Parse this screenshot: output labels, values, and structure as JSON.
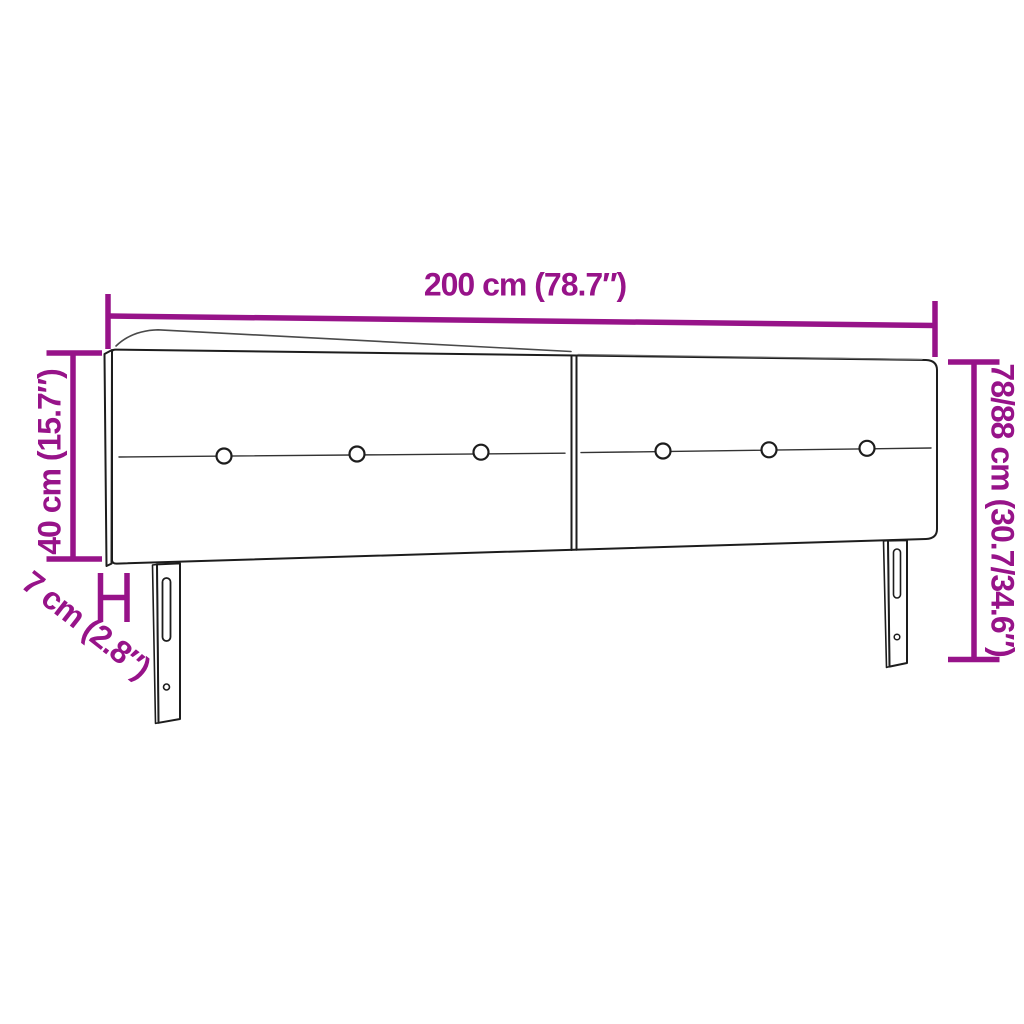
{
  "meta": {
    "description": "Line-art dimension diagram of a two-panel upholstered headboard with six tufting buttons and two slotted mounting legs",
    "background": "#ffffff",
    "accent_color": "#971389",
    "line_color": "#1d1d1d"
  },
  "dimensions": {
    "width_top": "200 cm (78.7″)",
    "height_left": "40 cm (15.7″)",
    "depth_bottom_left": "7 cm (2.8″)",
    "height_right": "78/88 cm (30.7/34.6″)"
  }
}
